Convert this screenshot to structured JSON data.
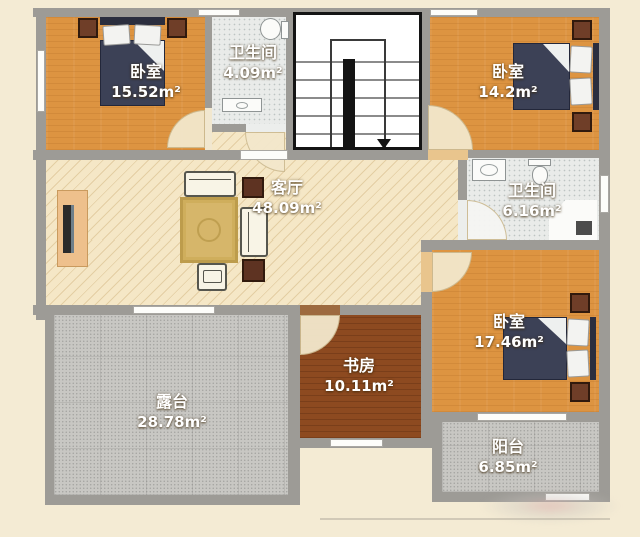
{
  "floorplan": {
    "type": "residential-floor-plan",
    "language": "zh-CN",
    "rooms": {
      "bedroom_top_left": {
        "label": "卧室",
        "area": "15.52m²"
      },
      "bathroom_top": {
        "label": "卫生间",
        "area": "4.09m²"
      },
      "bedroom_top_right": {
        "label": "卧室",
        "area": "14.2m²"
      },
      "living_room": {
        "label": "客厅",
        "area": "48.09m²"
      },
      "bathroom_mid": {
        "label": "卫生间",
        "area": "6.16m²"
      },
      "bedroom_bottom_right": {
        "label": "卧室",
        "area": "17.46m²"
      },
      "study": {
        "label": "书房",
        "area": "10.11m²"
      },
      "terrace": {
        "label": "露台",
        "area": "28.78m²"
      },
      "balcony": {
        "label": "阳台",
        "area": "6.85m²"
      }
    },
    "stairs": {
      "direction": "down"
    },
    "colors": {
      "background": "#f4ebd4",
      "wall": "#9d9b96",
      "bedroom_floor": "#dd9441",
      "living_floor": "#f5e7c6",
      "study_floor": "#8d4a20",
      "bathroom_floor": "#e9ebe9",
      "terrace_floor": "#c8c7c3",
      "bed": "#3c4156",
      "dark_furniture": "#6f3e28",
      "label_text": "#ffffff"
    }
  }
}
